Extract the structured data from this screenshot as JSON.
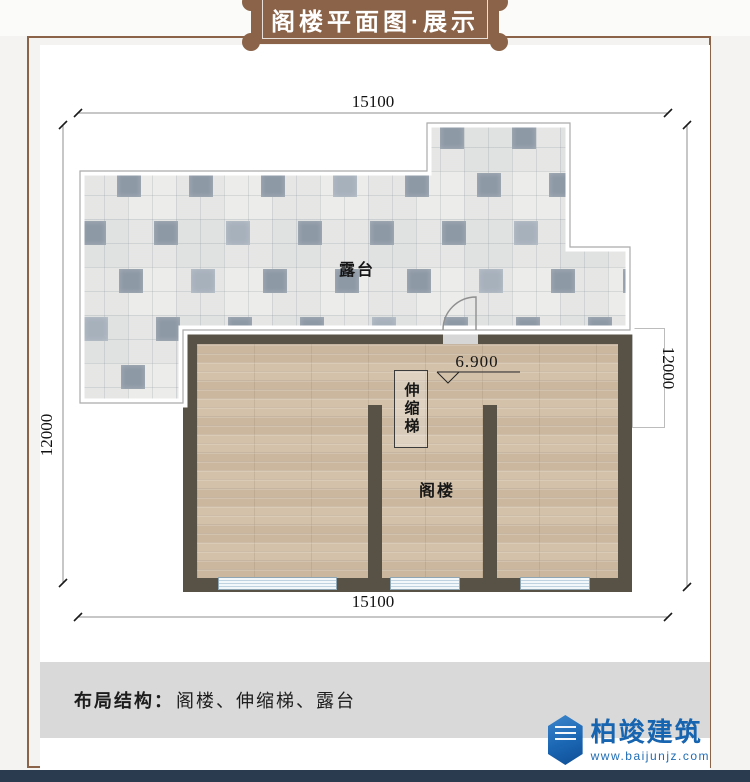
{
  "banner": {
    "title": "阁楼平面图·展示"
  },
  "plan": {
    "dimensions": {
      "top": "15100",
      "bottom": "15100",
      "left": "12000",
      "right": "12000"
    },
    "labels": {
      "terrace": "露台",
      "attic": "阁楼",
      "ladder": "伸缩梯",
      "level_mark": "6.900"
    }
  },
  "footer": {
    "structure_label": "布局结构：",
    "structure_value": "阁楼、伸缩梯、露台"
  },
  "brand": {
    "name": "柏竣建筑",
    "website": "www.baijunjz.com"
  },
  "colors": {
    "banner_brown": "#8a6348",
    "frame_brown": "#8a6348",
    "wall_dark": "#575146",
    "wood_floor": "#d3c1a9",
    "tile_dark": "#8e99a6",
    "window_blue": "#cfe0ea",
    "footer_gray": "#d9d9d9",
    "brand_blue": "#1764b0",
    "bottom_navy": "#2a3b50"
  }
}
